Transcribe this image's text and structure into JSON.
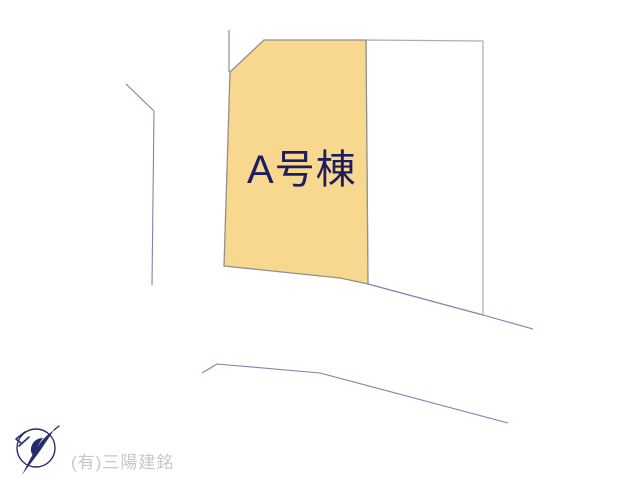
{
  "page": {
    "background": "#ffffff",
    "width": 640,
    "height": 480
  },
  "plan": {
    "lot_label": "A号棟",
    "lot_label_color": "#1d1d5f",
    "lot_fill": "#f8d78e",
    "lot_stroke": "#92908a",
    "adjacent_lot_fill": "#ffffff",
    "adjacent_lot_stroke": "#a9acba",
    "line_color": "#7c83ad",
    "shapes": [
      {
        "name": "adjacent-lot-polygon",
        "type": "polygon",
        "points": "366,40 483,41 483,315 368,284",
        "fill": "#ffffff",
        "stroke": "#a9acba",
        "stroke_width": 1.2
      },
      {
        "name": "lot-a-polygon",
        "type": "polygon",
        "points": "264,40 366,40 368,284 340,278 224,266 230,72",
        "fill": "#f8d78e",
        "stroke": "#92908a",
        "stroke_width": 1.3
      },
      {
        "name": "north-boundary-line",
        "type": "polyline",
        "points": "229,30 229,72",
        "fill": "none",
        "stroke": "#7c83ad",
        "stroke_width": 1.1
      },
      {
        "name": "west-road-line",
        "type": "polyline",
        "points": "126,84 154,111 152,285",
        "fill": "none",
        "stroke": "#7c83ad",
        "stroke_width": 1.1
      },
      {
        "name": "southeast-boundary-line",
        "type": "polyline",
        "points": "368,284 483,315 533,329",
        "fill": "none",
        "stroke": "#7c83ad",
        "stroke_width": 1.1
      },
      {
        "name": "south-road-line",
        "type": "polyline",
        "points": "202,373 217,364 320,373 508,423",
        "fill": "none",
        "stroke": "#7c83ad",
        "stroke_width": 1.1
      }
    ]
  },
  "footer": {
    "company_name": "(有)三陽建銘",
    "company_color": "#c7c7c7",
    "logo_icon": "compass-bird-logo-icon",
    "logo_color": "#252c6d"
  }
}
